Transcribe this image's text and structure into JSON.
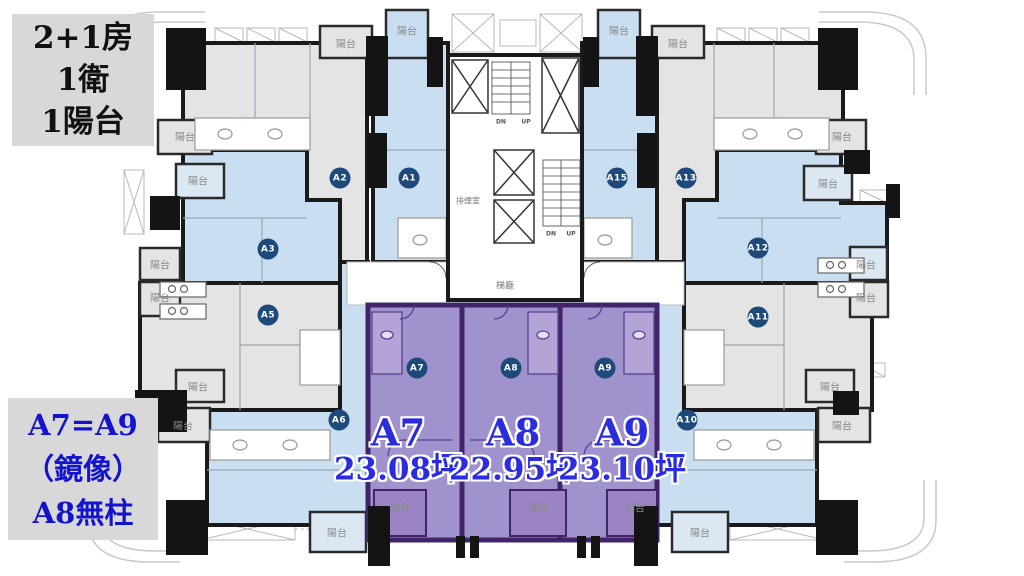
{
  "info_boxes": {
    "top": {
      "lines": [
        "2+1房",
        "1衛",
        "1陽台"
      ]
    },
    "bottom": {
      "lines": [
        "A7=A9",
        "（鏡像）",
        "A8無柱"
      ]
    }
  },
  "highlight": {
    "units": [
      {
        "name": "A7",
        "area": "23.08坪",
        "x": 398,
        "y": 451
      },
      {
        "name": "A8",
        "area": "22.95坪",
        "x": 513,
        "y": 451
      },
      {
        "name": "A9",
        "area": "23.10坪",
        "x": 622,
        "y": 451
      }
    ]
  },
  "floorplan": {
    "unit_badges": [
      {
        "id": "A2",
        "x": 340,
        "y": 178
      },
      {
        "id": "A1",
        "x": 409,
        "y": 178
      },
      {
        "id": "A15",
        "x": 617,
        "y": 178
      },
      {
        "id": "A13",
        "x": 686,
        "y": 178
      },
      {
        "id": "A3",
        "x": 268,
        "y": 249
      },
      {
        "id": "A12",
        "x": 758,
        "y": 248
      },
      {
        "id": "A5",
        "x": 268,
        "y": 315
      },
      {
        "id": "A11",
        "x": 758,
        "y": 317
      },
      {
        "id": "A7",
        "x": 417,
        "y": 368
      },
      {
        "id": "A8",
        "x": 511,
        "y": 368
      },
      {
        "id": "A9",
        "x": 605,
        "y": 368
      },
      {
        "id": "A6",
        "x": 339,
        "y": 420
      },
      {
        "id": "A10",
        "x": 687,
        "y": 420
      }
    ],
    "small_labels": [
      {
        "name": "balcony-label",
        "text": "陽台",
        "x": 346,
        "y": 43,
        "cls": ""
      },
      {
        "name": "balcony-label",
        "text": "陽台",
        "x": 407,
        "y": 30,
        "cls": ""
      },
      {
        "name": "balcony-label",
        "text": "陽台",
        "x": 619,
        "y": 30,
        "cls": ""
      },
      {
        "name": "balcony-label",
        "text": "陽台",
        "x": 678,
        "y": 43,
        "cls": ""
      },
      {
        "name": "balcony-label",
        "text": "陽台",
        "x": 185,
        "y": 136,
        "cls": ""
      },
      {
        "name": "balcony-label",
        "text": "陽台",
        "x": 198,
        "y": 180,
        "cls": ""
      },
      {
        "name": "balcony-label",
        "text": "陽台",
        "x": 160,
        "y": 264,
        "cls": ""
      },
      {
        "name": "balcony-label",
        "text": "陽台",
        "x": 160,
        "y": 297,
        "cls": ""
      },
      {
        "name": "balcony-label",
        "text": "陽台",
        "x": 198,
        "y": 386,
        "cls": ""
      },
      {
        "name": "balcony-label",
        "text": "陽台",
        "x": 183,
        "y": 425,
        "cls": ""
      },
      {
        "name": "balcony-label",
        "text": "陽台",
        "x": 842,
        "y": 136,
        "cls": ""
      },
      {
        "name": "balcony-label",
        "text": "陽台",
        "x": 828,
        "y": 183,
        "cls": ""
      },
      {
        "name": "balcony-label",
        "text": "陽台",
        "x": 866,
        "y": 264,
        "cls": ""
      },
      {
        "name": "balcony-label",
        "text": "陽台",
        "x": 866,
        "y": 297,
        "cls": ""
      },
      {
        "name": "balcony-label",
        "text": "陽台",
        "x": 830,
        "y": 386,
        "cls": ""
      },
      {
        "name": "balcony-label",
        "text": "陽台",
        "x": 842,
        "y": 425,
        "cls": ""
      },
      {
        "name": "balcony-label",
        "text": "陽台",
        "x": 337,
        "y": 532,
        "cls": ""
      },
      {
        "name": "balcony-label",
        "text": "陽台",
        "x": 400,
        "y": 507,
        "cls": ""
      },
      {
        "name": "balcony-label",
        "text": "陽台",
        "x": 538,
        "y": 507,
        "cls": ""
      },
      {
        "name": "balcony-label",
        "text": "陽台",
        "x": 635,
        "y": 507,
        "cls": ""
      },
      {
        "name": "balcony-label",
        "text": "陽台",
        "x": 700,
        "y": 532,
        "cls": ""
      },
      {
        "name": "elevator-hall-label",
        "text": "梯廳",
        "x": 505,
        "y": 285,
        "cls": "hall"
      },
      {
        "name": "smoke-room-label",
        "text": "排煙室",
        "x": 468,
        "y": 201,
        "cls": "smoke"
      },
      {
        "name": "stair-direction-label",
        "text": "DN",
        "x": 501,
        "y": 122,
        "cls": "stair"
      },
      {
        "name": "stair-direction-label",
        "text": "UP",
        "x": 526,
        "y": 122,
        "cls": "stair"
      },
      {
        "name": "stair-direction-label",
        "text": "DN",
        "x": 551,
        "y": 234,
        "cls": "stair"
      },
      {
        "name": "stair-direction-label",
        "text": "UP",
        "x": 571,
        "y": 234,
        "cls": "stair"
      }
    ],
    "colors": {
      "unit_blue": "#cadef1",
      "unit_gray": "#e4e4e4",
      "unit_purple": "#a092cc",
      "purple_balcony": "#9b83c4",
      "purple_wall": "#42246b",
      "wall_black": "#141414",
      "badge_bg": "#1d4a7a",
      "highlight_text": "#2b2bdf",
      "info_text_blue": "#1414cc",
      "small_label_text": "#8a8a8a"
    }
  }
}
